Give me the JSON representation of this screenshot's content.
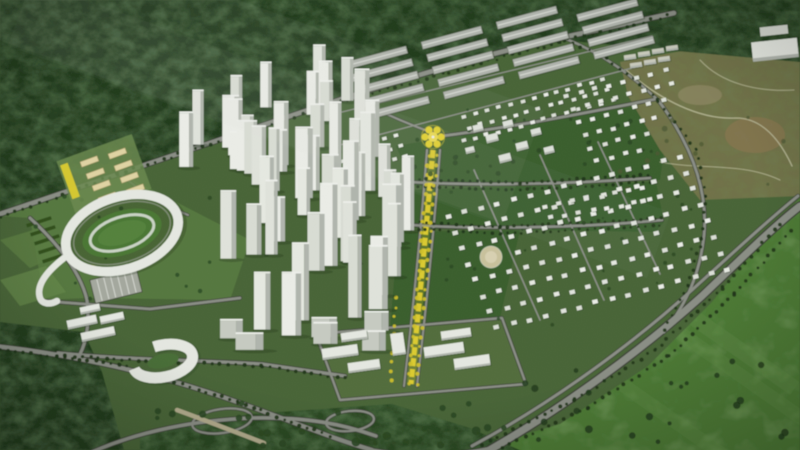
{
  "meta": {
    "kind": "aerial-3d-masterplan-rendering",
    "width": 800,
    "height": 450
  },
  "scene": {
    "description": "Bird's-eye 3D rendering of a planned urban township: forest belt at top, white high-rise tower cluster at center-left, oval stadium at left, cream cultural blocks, yellow central boulevard with flower-shaped plaza, gray row buildings at top-center, villa districts at right with round tan plaza, olive undeveloped hills top-right, ring-shaped building and highway interchanges at bottom, bright meadow bottom-right",
    "colors": {
      "dev": "#4a673a",
      "forest": "#243d20",
      "forest2": "#2c4a25",
      "meadow": "#4f7c38",
      "meadow_hi": "#63924a",
      "park": "#3c5f2f",
      "lawn": "#587a42",
      "civic_ground": "#546f3e",
      "olive": "#74744b",
      "brown": "#8a7752",
      "sand": "#cfc6a2",
      "sand_hi": "#ded6b8",
      "road": "#8e918a",
      "road_dark": "#3f423a",
      "road_light": "#a9aca4",
      "terrain_road": "#c3c3a2",
      "white": "#eceee9",
      "white_hi": "#f5f6f3",
      "shade": "#b6bab3",
      "gray": "#b5b8b2",
      "gray_ridge": "#dadcd7",
      "cream": "#e7d9a9",
      "cream_edge": "#b09f6d",
      "yellow": "#e8d531",
      "yellow_soft": "#f5e96b",
      "tree_dark": "#22361c",
      "tree_yellow": "#d6c52e",
      "tree_park": "#2c4a26",
      "olive_tree": "#4f5a35",
      "shadow": "#1e3018",
      "haze": "#e6eef0"
    }
  },
  "render": {
    "seed": 1337,
    "villaPalette": [
      "#eef0ea",
      "#e8eae4",
      "#f3f4f0",
      "#e2e5de"
    ],
    "towerPalette": [
      "#edefe9",
      "#e6e9e2",
      "#dfe2db",
      "#f2f3ef"
    ],
    "villaZones": [
      {
        "ox": 338,
        "oy": 151,
        "ux": 11.5,
        "uy": -3.1,
        "cols": 24,
        "vx": 5,
        "vy": 10.5,
        "rows": 6,
        "w": 4.6,
        "h": 3.4,
        "angle": -15,
        "clipRect": [
          328,
          16,
          640,
          260
        ],
        "clipLine": {
          "x1": 336,
          "y1": 179,
          "x2": 634,
          "y2": 97,
          "keep": "above"
        },
        "skipCircles": [
          [
            433,
            139,
            30
          ]
        ]
      },
      {
        "ox": 567,
        "oy": 96,
        "ux": 14,
        "uy": -3.6,
        "cols": 10,
        "vx": 6,
        "vy": 13,
        "rows": 6,
        "w": 5,
        "h": 3.8,
        "angle": -14,
        "clipRect": [
          540,
          40,
          702,
          185
        ],
        "clipLine": {
          "x1": 688,
          "y1": 40,
          "x2": 640,
          "y2": 170,
          "keep": "above"
        }
      },
      {
        "ox": 448,
        "oy": 216,
        "ux": 16.5,
        "uy": -4.2,
        "cols": 15,
        "vx": 7,
        "vy": 16,
        "rows": 8,
        "w": 5.5,
        "h": 4.2,
        "angle": -14,
        "clipRect": [
          444,
          142,
          740,
          336
        ],
        "skipCircles": [
          [
            491,
            257,
            15
          ]
        ]
      },
      {
        "ox": 545,
        "oy": 206,
        "ux": 14,
        "uy": -2.5,
        "cols": 8,
        "vx": 6,
        "vy": 12,
        "rows": 2,
        "w": 5,
        "h": 3.8,
        "angle": -12
      }
    ],
    "factory": {
      "ox": 346,
      "oy": 62,
      "ux": 75,
      "uy": -20,
      "cols": 4,
      "vx": 5.5,
      "vy": 12.5,
      "rows": 5,
      "len": 62,
      "th": 7.5,
      "angle": -15,
      "clipRect": [
        330,
        13,
        672,
        130
      ]
    },
    "towerZones": [
      {
        "x0": 186,
        "x1": 298,
        "y0": 102,
        "y1": 195,
        "n": 11,
        "h0": 34,
        "h1": 62,
        "w0": 11,
        "w1": 17
      },
      {
        "x0": 222,
        "x1": 362,
        "y0": 152,
        "y1": 262,
        "n": 13,
        "h0": 40,
        "h1": 76,
        "w0": 12,
        "w1": 19
      },
      {
        "x0": 252,
        "x1": 402,
        "y0": 228,
        "y1": 344,
        "n": 15,
        "h0": 44,
        "h1": 86,
        "w0": 12,
        "w1": 20
      },
      {
        "x0": 300,
        "x1": 418,
        "y0": 152,
        "y1": 242,
        "n": 7,
        "h0": 50,
        "h1": 80,
        "w0": 12,
        "w1": 16
      },
      {
        "x0": 300,
        "x1": 398,
        "y0": 96,
        "y1": 152,
        "n": 7,
        "h0": 36,
        "h1": 58,
        "w0": 11,
        "w1": 15
      },
      {
        "x0": 196,
        "x1": 392,
        "y0": 330,
        "y1": 368,
        "n": 6,
        "h0": 13,
        "h1": 22,
        "w0": 20,
        "w1": 30,
        "low": true
      }
    ],
    "treeRows": [
      {
        "pts": [
          [
            0,
            218
          ],
          [
            118,
            174
          ],
          [
            348,
            100
          ],
          [
            560,
            42
          ],
          [
            668,
            16
          ]
        ],
        "step": 8,
        "r": 1.7,
        "c": "tree_dark",
        "j": 1.5
      },
      {
        "pts": [
          [
            58,
            356
          ],
          [
            170,
            362
          ],
          [
            262,
            366
          ],
          [
            345,
            378
          ]
        ],
        "step": 8,
        "r": 1.8,
        "c": "tree_dark",
        "j": 1.2
      },
      {
        "pts": [
          [
            412,
            179
          ],
          [
            520,
            183
          ],
          [
            648,
            175
          ]
        ],
        "step": 7,
        "r": 1.7,
        "c": "tree_dark",
        "j": 0.8
      },
      {
        "pts": [
          [
            410,
            186
          ],
          [
            520,
            190
          ],
          [
            650,
            182
          ]
        ],
        "step": 7,
        "r": 1.6,
        "c": "tree_dark",
        "j": 0.8
      },
      {
        "pts": [
          [
            398,
            221
          ],
          [
            500,
            227
          ],
          [
            662,
            218
          ]
        ],
        "step": 7,
        "r": 1.7,
        "c": "tree_dark",
        "j": 0.8
      },
      {
        "pts": [
          [
            396,
            228
          ],
          [
            500,
            234
          ],
          [
            660,
            225
          ]
        ],
        "step": 7,
        "r": 1.6,
        "c": "tree_dark",
        "j": 0.8
      },
      {
        "pts": [
          [
            482,
            444
          ],
          [
            575,
            400
          ],
          [
            655,
            350
          ],
          [
            722,
            288
          ],
          [
            780,
            224
          ]
        ],
        "step": 8,
        "r": 1.8,
        "c": "tree_dark",
        "j": 1.2
      },
      {
        "pts": [
          [
            494,
            452
          ],
          [
            588,
            408
          ],
          [
            668,
            356
          ],
          [
            734,
            294
          ],
          [
            792,
            230
          ]
        ],
        "step": 8,
        "r": 1.8,
        "c": "tree_dark",
        "j": 1.2
      },
      {
        "pts": [
          [
            658,
            102
          ],
          [
            696,
            150
          ],
          [
            706,
            196
          ],
          [
            702,
            238
          ],
          [
            688,
            286
          ],
          [
            664,
            330
          ]
        ],
        "step": 8,
        "r": 1.6,
        "c": "tree_dark",
        "j": 1.0
      },
      {
        "pts": [
          [
            0,
            350
          ],
          [
            120,
            364
          ],
          [
            238,
            402
          ],
          [
            330,
            436
          ]
        ],
        "step": 8,
        "r": 1.8,
        "c": "tree_dark",
        "j": 1.2
      },
      {
        "pts": [
          [
            564,
            40
          ],
          [
            606,
            58
          ],
          [
            640,
            84
          ],
          [
            658,
            100
          ]
        ],
        "step": 8,
        "r": 1.6,
        "c": "tree_dark",
        "j": 1.0
      },
      {
        "pts": [
          [
            429,
            156
          ],
          [
            419,
            270
          ],
          [
            409,
            384
          ]
        ],
        "step": 9,
        "r": 2.0,
        "c": "tree_yellow",
        "j": 1.0
      },
      {
        "pts": [
          [
            437,
            156
          ],
          [
            427,
            270
          ],
          [
            417,
            384
          ]
        ],
        "step": 9,
        "r": 1.8,
        "c": "tree_yellow",
        "j": 1.0
      },
      {
        "pts": [
          [
            396,
            298
          ],
          [
            391,
            380
          ]
        ],
        "step": 9,
        "r": 1.8,
        "c": "tree_yellow",
        "j": 1.0
      }
    ],
    "scatter": [
      {
        "x0": 402,
        "y0": 108,
        "x1": 648,
        "y1": 175,
        "n": 26,
        "r0": 1.3,
        "r1": 2.6,
        "c": "tree_park",
        "op": 0.85
      },
      {
        "x0": 440,
        "y0": 150,
        "x1": 716,
        "y1": 330,
        "n": 26,
        "r0": 1.1,
        "r1": 2.0,
        "c": "tree_park",
        "op": 0.8
      },
      {
        "x0": 520,
        "y0": 360,
        "x1": 790,
        "y1": 445,
        "n": 22,
        "r0": 2.0,
        "r1": 4.2,
        "c": "forest",
        "op": 0.85
      },
      {
        "x0": 150,
        "y0": 402,
        "x1": 520,
        "y1": 446,
        "n": 26,
        "r0": 2.2,
        "r1": 4.5,
        "c": "forest2",
        "op": 0.9
      },
      {
        "x0": 16,
        "y0": 190,
        "x1": 225,
        "y1": 300,
        "n": 14,
        "r0": 1.4,
        "r1": 2.4,
        "c": "tree_park",
        "op": 0.8
      },
      {
        "x0": 620,
        "y0": 58,
        "x1": 790,
        "y1": 190,
        "n": 12,
        "r0": 1.5,
        "r1": 3.0,
        "c": "olive_tree",
        "op": 0.7
      }
    ],
    "civicSlabs": [
      [
        340,
        352,
        36,
        11,
        -8
      ],
      [
        354,
        336,
        26,
        9,
        -8
      ],
      [
        364,
        366,
        32,
        10,
        -8
      ],
      [
        398,
        344,
        13,
        22,
        -8
      ],
      [
        444,
        350,
        40,
        11,
        -8
      ],
      [
        456,
        334,
        30,
        9,
        -8
      ],
      [
        472,
        362,
        36,
        11,
        -8
      ]
    ],
    "campusSlabs": [
      [
        82,
        322,
        30,
        9,
        -12
      ],
      [
        98,
        334,
        34,
        9,
        -12
      ],
      [
        112,
        318,
        24,
        8,
        -12
      ],
      [
        90,
        309,
        20,
        7,
        -12
      ]
    ],
    "pavilions": [
      [
        478,
        128,
        10,
        7,
        -14
      ],
      [
        492,
        138,
        12,
        8,
        -14
      ],
      [
        508,
        124,
        10,
        7,
        -14
      ],
      [
        522,
        146,
        12,
        8,
        -14
      ],
      [
        536,
        132,
        10,
        7,
        -14
      ],
      [
        549,
        150,
        10,
        7,
        -14
      ],
      [
        505,
        158,
        12,
        8,
        -14
      ],
      [
        470,
        150,
        9,
        6,
        -14
      ]
    ],
    "shedsTR": [
      [
        630,
        57,
        12,
        5,
        -8
      ],
      [
        644,
        54,
        12,
        5,
        -8
      ],
      [
        658,
        51,
        12,
        5,
        -8
      ],
      [
        672,
        48,
        12,
        5,
        -8
      ],
      [
        636,
        65,
        12,
        5,
        -8
      ],
      [
        650,
        62,
        12,
        5,
        -8
      ],
      [
        664,
        59,
        12,
        5,
        -8
      ]
    ],
    "creamBlocks": [
      [
        80,
        162
      ],
      [
        86,
        174
      ],
      [
        92,
        186
      ],
      [
        98,
        198
      ],
      [
        108,
        154
      ],
      [
        114,
        166
      ],
      [
        120,
        178
      ],
      [
        126,
        190
      ]
    ],
    "cream": {
      "len": 18,
      "th": 5.5,
      "angle": -20
    }
  }
}
